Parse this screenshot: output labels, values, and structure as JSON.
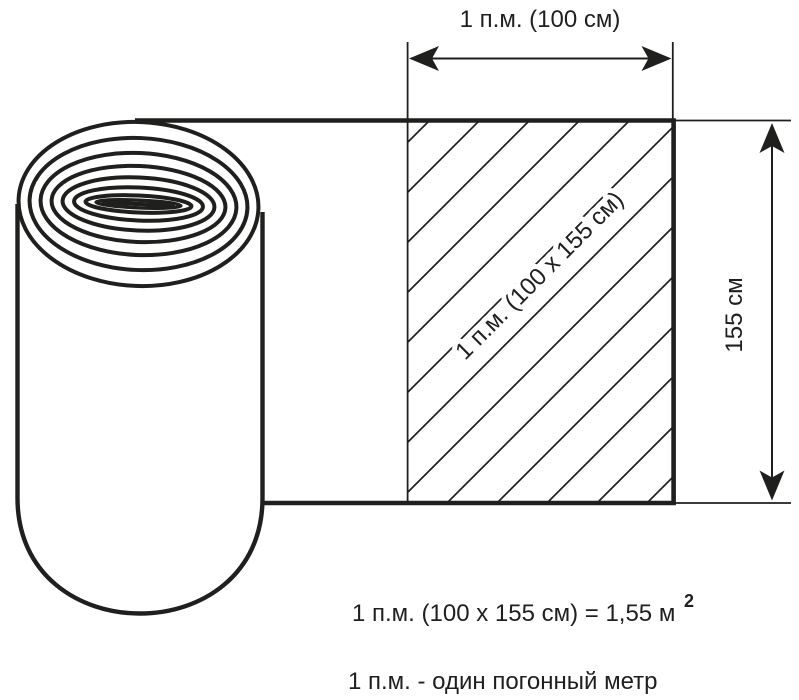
{
  "diagram": {
    "labels": {
      "top_dimension": "1 п.м. (100 см)",
      "side_dimension": "155 см",
      "hatched_area": "1 п.м. (100 х 155 см)",
      "formula": "1 п.м. (100 х 155 см) = 1,55 м",
      "formula_superscript": "2",
      "definition": "1 п.м. - один погонный метр"
    },
    "dimensions": {
      "width_cm": "100",
      "height_cm": "155",
      "area_m2": "1,55"
    },
    "colors": {
      "ink": "#1f1f1d",
      "background": "#ffffff"
    }
  }
}
